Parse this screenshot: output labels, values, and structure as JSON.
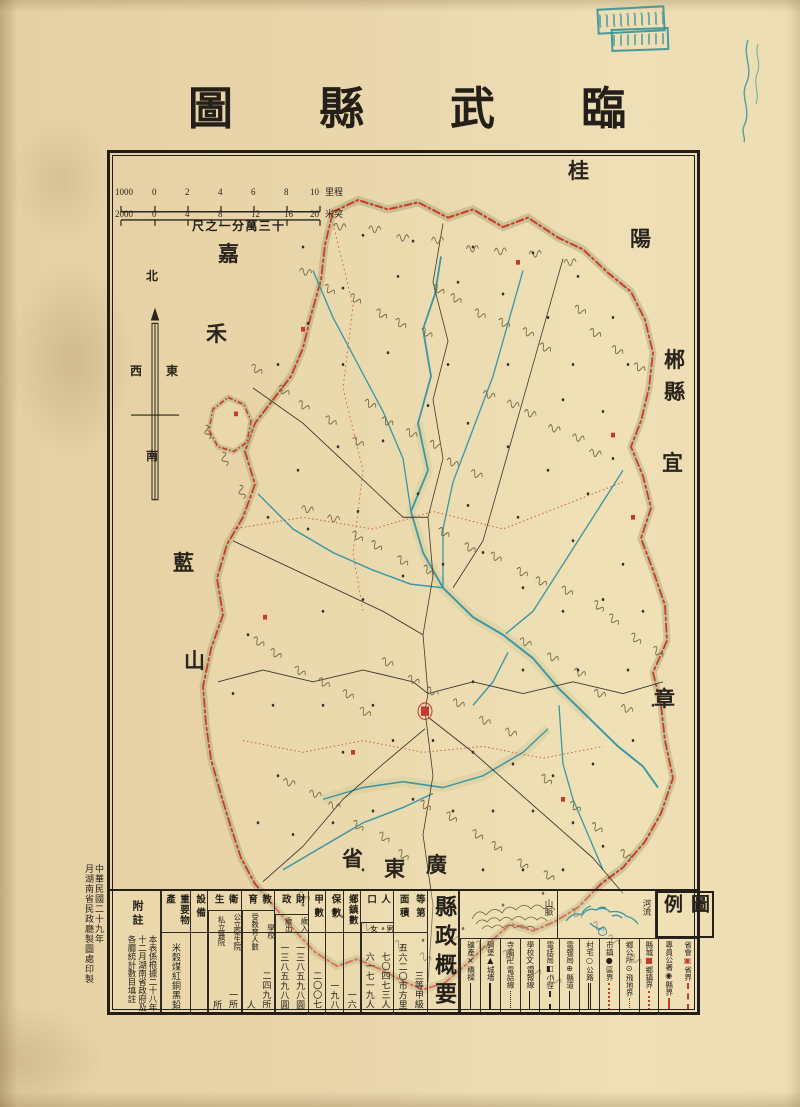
{
  "colors": {
    "ink": "#241f18",
    "red": "#c43b2e",
    "teal": "#2e8f96",
    "river": "#3b97a5",
    "olive": "#7a6c45"
  },
  "title": {
    "text": "臨武縣圖"
  },
  "scale_bar": {
    "ratio_label": "十三萬分一之尺",
    "top": {
      "left": "1000",
      "ticks": [
        "0",
        "2",
        "4",
        "6",
        "8",
        "10"
      ],
      "unit": "里程"
    },
    "bottom": {
      "left": "2000",
      "ticks": [
        "0",
        "4",
        "8",
        "12",
        "16",
        "20"
      ],
      "unit": "米突"
    }
  },
  "compass": {
    "n": "北",
    "s": "南",
    "e": "東",
    "w": "西"
  },
  "map": {
    "neighbor_names": [
      "桂陽",
      "嘉禾",
      "郴縣",
      "宜章",
      "藍山",
      "廣東省"
    ]
  },
  "legend": {
    "title": "圖例",
    "sections": {
      "mountain": "山脈",
      "river": "河流"
    },
    "items": [
      {
        "feature": "省會",
        "symbol": "▣",
        "symbol_color": "#c43b2e",
        "boundary": "省界",
        "line_style": "dashdot",
        "line_color": "#c43b2e"
      },
      {
        "feature": "專員公署",
        "symbol": "◉",
        "symbol_color": "#241f18",
        "boundary": "縣界",
        "line_style": "dash",
        "line_color": "#c43b2e"
      },
      {
        "feature": "縣城",
        "symbol": "■",
        "symbol_color": "#c43b2e",
        "boundary": "鄉鎮界",
        "line_style": "dot",
        "line_color": "#c43b2e"
      },
      {
        "feature": "鄉公所",
        "symbol": "⊙",
        "symbol_color": "#241f18",
        "boundary": "飛地界",
        "line_style": "finedot",
        "line_color": "#c43b2e"
      },
      {
        "feature": "市鎮",
        "symbol": "●",
        "symbol_color": "#241f18",
        "boundary": "區界",
        "line_style": "dot",
        "line_color": "#c43b2e"
      },
      {
        "feature": "村宅",
        "symbol": "○",
        "symbol_color": "#241f18",
        "boundary": "公路",
        "line_style": "double",
        "line_color": "#241f18"
      },
      {
        "feature": "電報局",
        "symbol": "⊕",
        "symbol_color": "#241f18",
        "boundary": "縣道",
        "line_style": "solid",
        "line_color": "#241f18"
      },
      {
        "feature": "電話局",
        "symbol": "◧",
        "symbol_color": "#241f18",
        "boundary": "小徑",
        "line_style": "dash",
        "line_color": "#241f18"
      },
      {
        "feature": "學校",
        "symbol": "文",
        "symbol_color": "#241f18",
        "boundary": "電報線",
        "line_style": "solid",
        "line_color": "#241f18"
      },
      {
        "feature": "寺廟",
        "symbol": "卍",
        "symbol_color": "#241f18",
        "boundary": "電話線",
        "line_style": "dotline",
        "line_color": "#241f18"
      },
      {
        "feature": "碉堡",
        "symbol": "▲",
        "symbol_color": "#241f18",
        "boundary": "城墻",
        "line_style": "cren",
        "line_color": "#241f18"
      },
      {
        "feature": "礦產",
        "symbol": "×",
        "symbol_color": "#241f18",
        "boundary": "橋樑",
        "line_style": "bridge",
        "line_color": "#241f18"
      }
    ]
  },
  "summary": {
    "title": "縣政概要",
    "groups": [
      {
        "name": "等第",
        "cols": [
          {
            "sub": "",
            "value": "三等甲級"
          }
        ]
      },
      {
        "name": "面積",
        "cols": [
          {
            "sub": "",
            "value": "五六二〇市方里"
          }
        ]
      },
      {
        "name": "人口",
        "cols": [
          {
            "sub": "男",
            "value": "七〇四七三人"
          },
          {
            "sub": "女",
            "value": "六一七一九人"
          }
        ]
      },
      {
        "name": "鄉鎮數",
        "cols": [
          {
            "sub": "",
            "value": "一六"
          }
        ]
      },
      {
        "name": "保數",
        "cols": [
          {
            "sub": "",
            "value": "一九八"
          }
        ]
      },
      {
        "name": "甲數",
        "cols": [
          {
            "sub": "",
            "value": "二〇〇七"
          }
        ]
      },
      {
        "name": "財政",
        "cols": [
          {
            "sub": "歲入",
            "value": "一三八五九八圓"
          },
          {
            "sub": "歲出",
            "value": "一三八五九八圓"
          }
        ]
      },
      {
        "name": "教育",
        "cols": [
          {
            "sub": "學校",
            "value": "二四九所"
          },
          {
            "sub": "受教育人數",
            "value": "人"
          }
        ]
      },
      {
        "name": "衛生",
        "cols": [
          {
            "sub": "公立衛生院",
            "value": "一所"
          },
          {
            "sub": "私立醫院",
            "value": "所"
          }
        ]
      },
      {
        "name": "設備",
        "cols": [
          {
            "sub": "",
            "value": ""
          }
        ]
      },
      {
        "name": "重要物產",
        "cols": [
          {
            "sub": "",
            "value": "米穀煤紅銅黑鉛"
          }
        ]
      }
    ]
  },
  "notes": {
    "title": "附註",
    "lines": [
      "本表係根據二十八年",
      "十二月湖南省政府及",
      "各廳統計數目填註"
    ]
  },
  "imprint": {
    "year_line": "中華民國二十九年",
    "print_line": "月湖南省民政廳製圖處印製"
  }
}
